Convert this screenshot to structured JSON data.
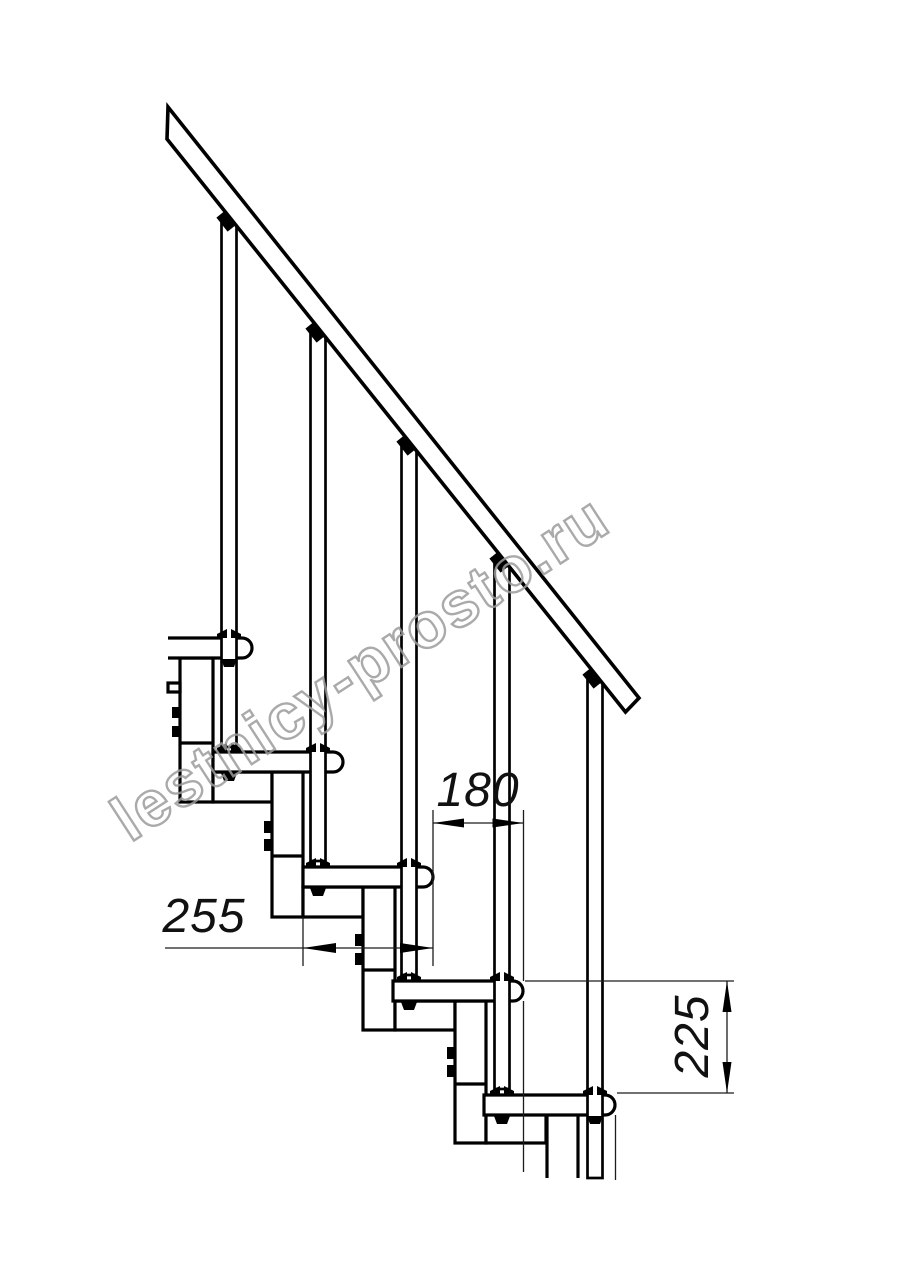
{
  "page": {
    "background": "#ffffff",
    "canvas_width": 914,
    "canvas_height": 1280
  },
  "drawing": {
    "type": "modular-staircase-side-view",
    "line_color": "#000000",
    "thin_line_color": "#1c1c1c",
    "structure": {
      "tread_count": 5,
      "baluster_count": 5,
      "module_count": 5,
      "has_handrail": true
    },
    "dimensions": {
      "tread_depth": {
        "value": "255",
        "orientation": "horizontal"
      },
      "going": {
        "value": "180",
        "orientation": "horizontal"
      },
      "rise": {
        "value": "225",
        "orientation": "vertical"
      }
    },
    "watermark": {
      "text": "lestnicy-prosto.ru",
      "color": "#9c9c9c",
      "rotation_deg": -33
    }
  }
}
